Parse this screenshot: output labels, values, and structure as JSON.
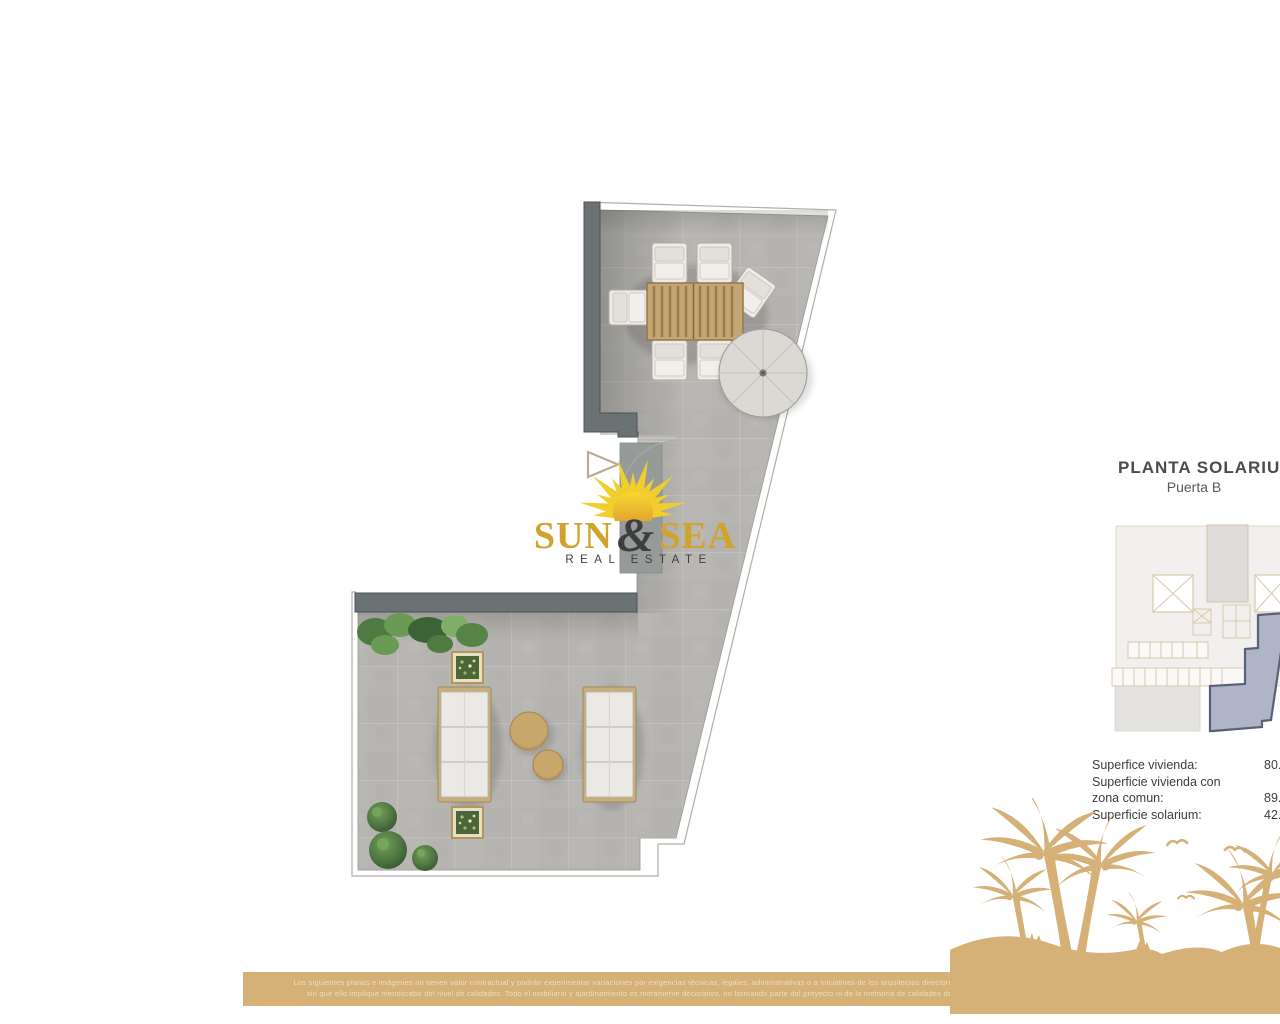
{
  "header": {
    "title": "PLANTA SOLARIUM",
    "subtitle": "Puerta B"
  },
  "logo": {
    "word1": "SUN",
    "ampersand": "&",
    "word2": "SEA",
    "tagline": "REAL ESTATE"
  },
  "areas": {
    "rows": [
      {
        "label": "Superfice vivienda:",
        "value": "80."
      },
      {
        "label": "Superficie vivienda con",
        "value": ""
      },
      {
        "label": "zona comun:",
        "value": "89."
      },
      {
        "label": "Superficie solarium:",
        "value": "42."
      }
    ]
  },
  "disclaimer": {
    "line1": "Los siguientes planos e imágenes no tienen valor contractual y podrán experimentar variaciones por exigencias técnicas, legales, administrativas o a iniciativas de los arquitectos directores de las obras",
    "line2": "sin que ello implique menoscabo del nivel de calidades. Todo el mobiliario y ajardinamiento es meramente decorativo, no formando parte del proyecto ni de la memoria de calidades del proyecto."
  },
  "plan": {
    "furniture": [
      "dining-table",
      "dining-chairs",
      "parasol",
      "sun-loungers",
      "side-tables",
      "planters",
      "plants",
      "door-swing",
      "entry-arrow"
    ],
    "keyplan_highlight": "unit-puerta-b"
  },
  "decor": {
    "palms": "palm-tree-silhouette",
    "birds": "seagull-silhouette"
  },
  "colors": {
    "accent_gold": "#d5b077",
    "logo_gold": "#d0a42c",
    "sun_yellow": "#f2ce2d",
    "floor_gray": "#b7b5b1",
    "wall_gray": "#6b7274",
    "highlight_unit": "#afb4c7",
    "keyplan_line_tan": "#d8c8ab"
  }
}
